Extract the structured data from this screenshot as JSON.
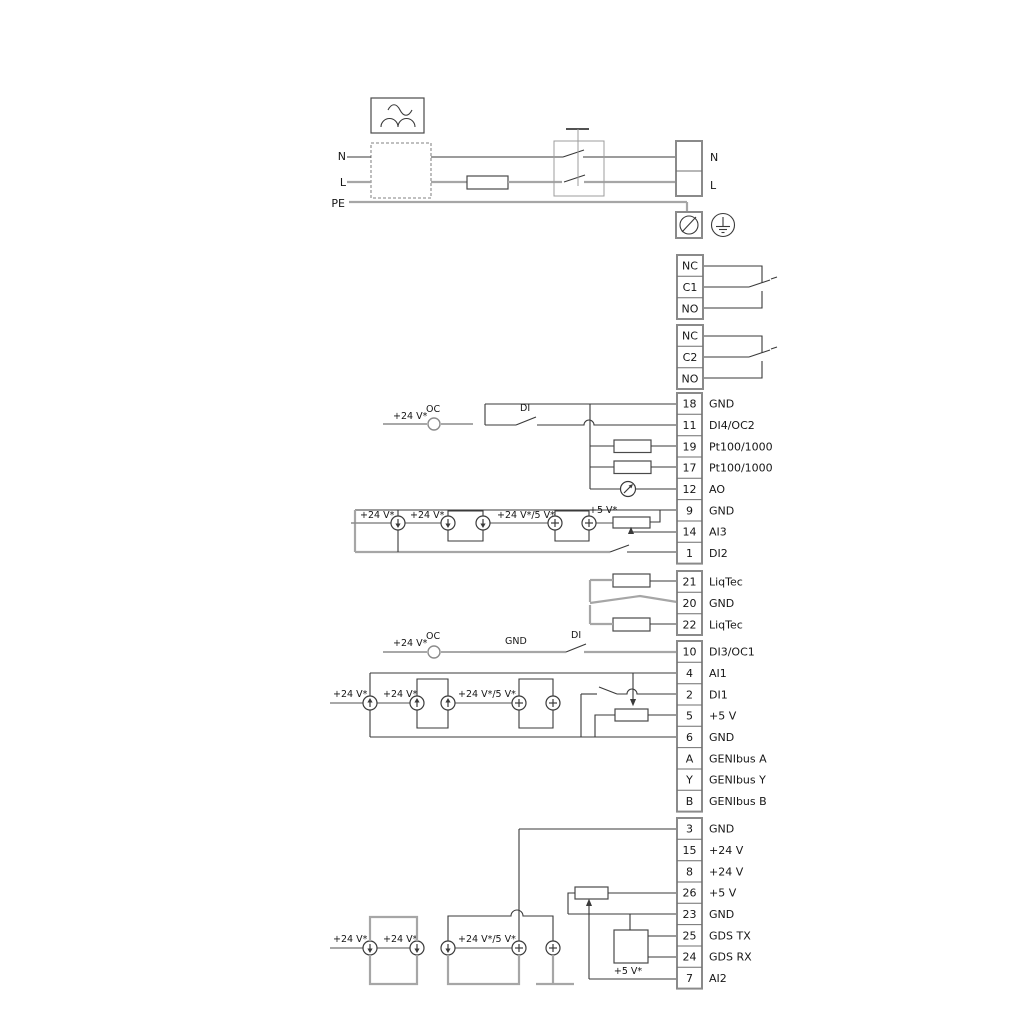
{
  "power": {
    "n_left": "N",
    "l_left": "L",
    "pe_left": "PE",
    "n_right": "N",
    "l_right": "L"
  },
  "relays": [
    {
      "rows": [
        "NC",
        "C1",
        "NO"
      ]
    },
    {
      "rows": [
        "NC",
        "C2",
        "NO"
      ]
    }
  ],
  "terminal_groups": [
    {
      "rows": [
        {
          "num": "18",
          "label": "GND"
        },
        {
          "num": "11",
          "label": "DI4/OC2"
        },
        {
          "num": "19",
          "label": "Pt100/1000"
        },
        {
          "num": "17",
          "label": "Pt100/1000"
        },
        {
          "num": "12",
          "label": "AO"
        },
        {
          "num": "9",
          "label": "GND"
        },
        {
          "num": "14",
          "label": "AI3"
        },
        {
          "num": "1",
          "label": "DI2"
        }
      ]
    },
    {
      "rows": [
        {
          "num": "21",
          "label": "LiqTec"
        },
        {
          "num": "20",
          "label": "GND"
        },
        {
          "num": "22",
          "label": "LiqTec"
        }
      ]
    },
    {
      "rows": [
        {
          "num": "10",
          "label": "DI3/OC1"
        },
        {
          "num": "4",
          "label": "AI1"
        },
        {
          "num": "2",
          "label": "DI1"
        },
        {
          "num": "5",
          "label": "+5 V"
        },
        {
          "num": "6",
          "label": "GND"
        },
        {
          "num": "A",
          "label": "GENIbus A"
        },
        {
          "num": "Y",
          "label": "GENIbus Y"
        },
        {
          "num": "B",
          "label": "GENIbus B"
        }
      ]
    },
    {
      "rows": [
        {
          "num": "3",
          "label": "GND"
        },
        {
          "num": "15",
          "label": "+24 V"
        },
        {
          "num": "8",
          "label": "+24 V"
        },
        {
          "num": "26",
          "label": "+5 V"
        },
        {
          "num": "23",
          "label": "GND"
        },
        {
          "num": "25",
          "label": "GDS TX"
        },
        {
          "num": "24",
          "label": "GDS RX"
        },
        {
          "num": "7",
          "label": "AI2"
        }
      ]
    }
  ],
  "ann": {
    "a": {
      "v24": "+24 V*",
      "oc": "OC",
      "di": "DI"
    },
    "b": {
      "v24a": "+24 V*",
      "v24b": "+24 V*",
      "v245": "+24 V*/5 V*",
      "v5": "+5 V*"
    },
    "c": {
      "v24": "+24 V*",
      "oc": "OC",
      "gnd": "GND",
      "di": "DI"
    },
    "d": {
      "v24a": "+24 V*",
      "v24b": "+24 V*",
      "v245": "+24 V*/5 V*"
    },
    "e": {
      "v24a": "+24 V*",
      "v24b": "+24 V*",
      "v245": "+24 V*/5 V*",
      "v5": "+5 V*"
    }
  },
  "colors": {
    "line_dark": "#3a3a3a",
    "line_gray": "#a6a6a6"
  }
}
